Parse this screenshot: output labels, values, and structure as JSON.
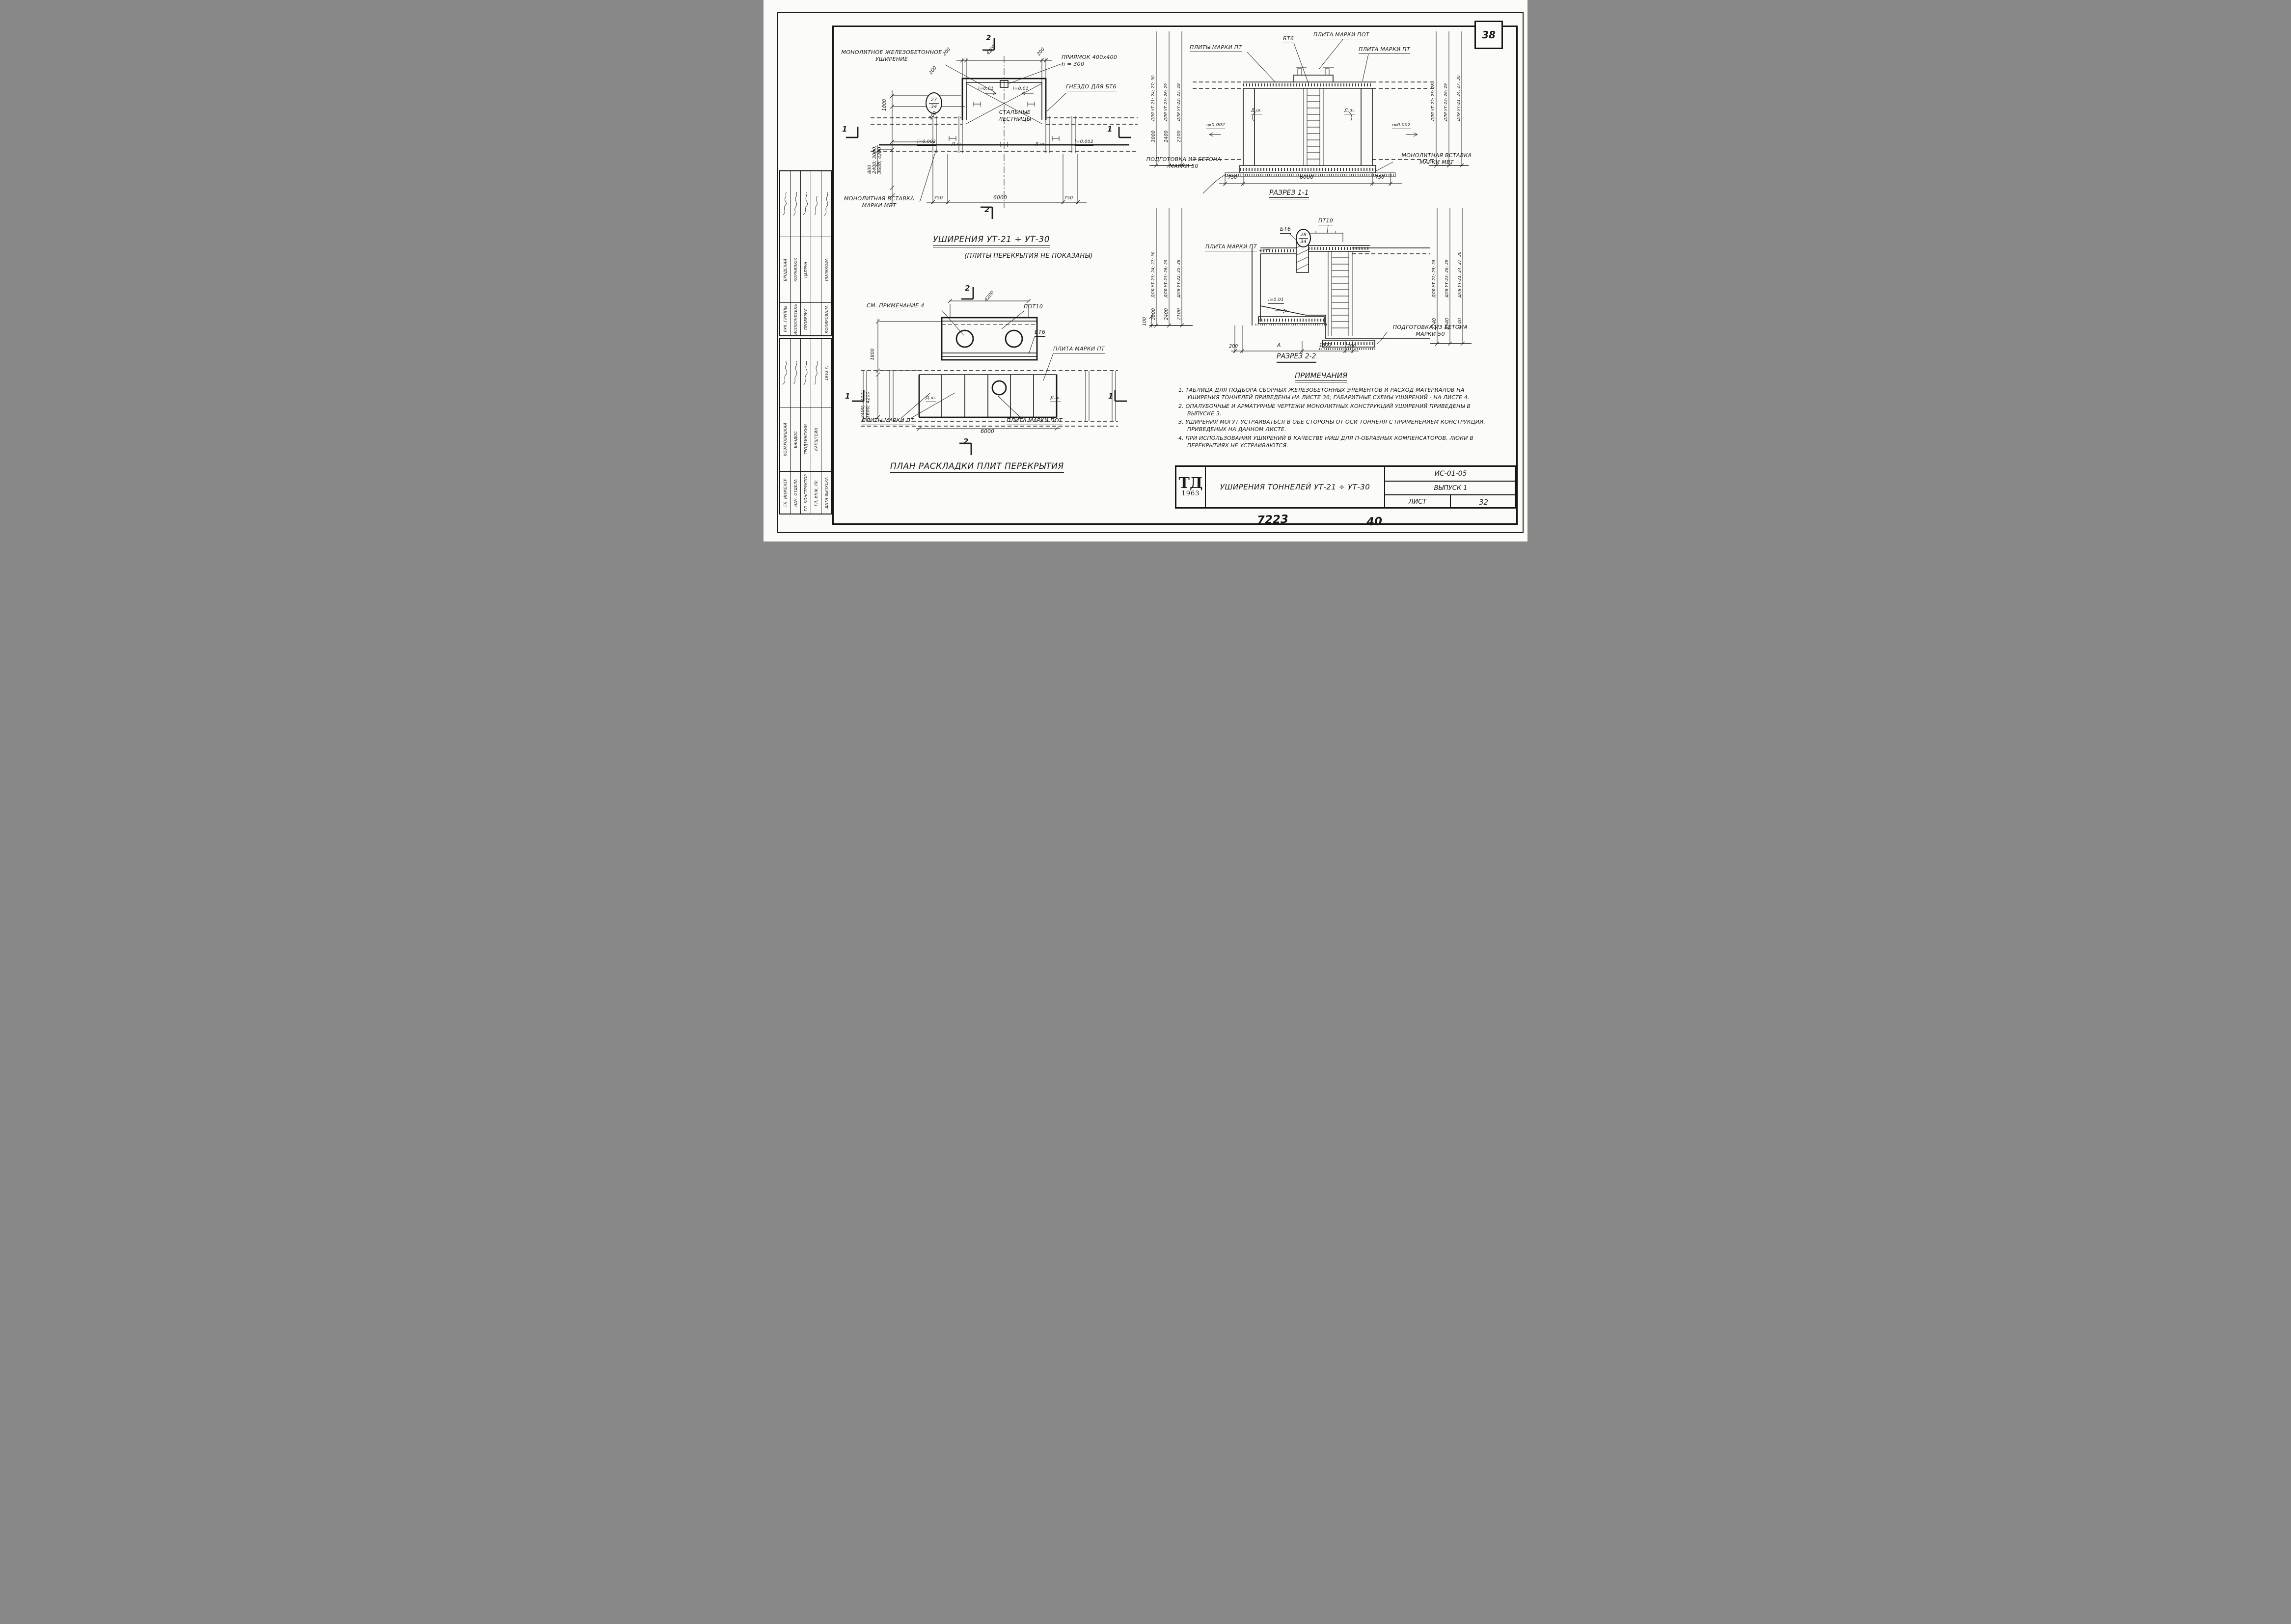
{
  "colors": {
    "ink": "#1a1a1a",
    "paper": "#fbfbf8"
  },
  "page": {
    "corner_number": "38",
    "footer_left": "7223",
    "footer_right": "40"
  },
  "sidebar": {
    "upper": [
      {
        "title": "РУК. ГРУППЫ",
        "name": "БРОДСКИЙ"
      },
      {
        "title": "ИСПОЛНИТЕЛЬ",
        "name": "КОРНИЛЮК"
      },
      {
        "title": "ПРОВЕРИЛ",
        "name": "ЦАПРУН"
      },
      {
        "title": "",
        "name": ""
      },
      {
        "title": "КОПИРОВАЛА",
        "name": "ПОЛЯКОВА"
      }
    ],
    "lower": [
      {
        "title": "ГЛ. ИНЖЕНЕР",
        "name": "КОЗАРОВИЦКИЙ"
      },
      {
        "title": "НАЧ. ОТДЕЛА",
        "name": "БАНДОС"
      },
      {
        "title": "ГЛ. КОНСТРУКТОР",
        "name": "ГРОДЗИНСКИЙ"
      },
      {
        "title": "ГЛ. ИНЖ. ПР.",
        "name": "КАПШТЕЙН"
      },
      {
        "title": "ДАТА ВЫПУСКА",
        "name": "1963 г."
      }
    ]
  },
  "plan_top": {
    "title": "УШИРЕНИЯ  УТ-21 ÷ УТ-30",
    "subtitle": "(ПЛИТЫ  ПЕРЕКРЫТИЯ  НЕ  ПОКАЗАНЫ)",
    "labels": {
      "widening": "МОНОЛИТНОЕ  ЖЕЛЕЗОБЕТОННОЕ\nУШИРЕНИЕ",
      "pit": "ПРИЯМОК  400х400\nh = 300",
      "socket": "ГНЕЗДО  ДЛЯ  БТ6",
      "stairs": "СТАЛЬНЫЕ\nЛЕСТНИЦЫ",
      "insert": "МОНОЛИТНАЯ  ВСТАВКА\nМАРКИ  МВТ",
      "slope_pit_left": "i=0.01",
      "slope_pit_right": "i=0.01",
      "slope_left": "i=0.002",
      "slope_right": "i=0.002",
      "joint_left": "Д.ш.",
      "joint_right": "Д.ш."
    },
    "detail_mark": {
      "top": "27",
      "bottom": "34"
    },
    "dims": {
      "top": [
        "200",
        "4200",
        "200"
      ],
      "left": [
        "200",
        "1800",
        "200"
      ],
      "left_range": "2400; 3000;\n3600; 4200",
      "left_lower": "800",
      "bottom": [
        "750",
        "6000",
        "750"
      ]
    },
    "marks": {
      "top": "2",
      "bottom": "2",
      "left": "1",
      "right": "1"
    }
  },
  "plan_bottom": {
    "title": "ПЛАН  РАСКЛАДКИ  ПЛИТ  ПЕРЕКРЫТИЯ",
    "labels": {
      "see_note": "СМ. ПРИМЕЧАНИЕ  4",
      "pot10": "ПОТ10",
      "bt6": "БТ6",
      "plate_pt": "ПЛИТА  МАРКИ  ПТ",
      "plates_pt": "ПЛИТЫ  МАРКИ  ПТ",
      "plate_pot": "ПЛИТА  МАРКИ  ПОТ",
      "joint_left": "Д.ш.",
      "joint_right": "Д.ш."
    },
    "dims": {
      "top": "4200",
      "left": "1800",
      "left_range": "2400; 3000;\n3600; 4200",
      "bottom": "6000"
    },
    "marks": {
      "top": "2",
      "bottom": "2",
      "left": "1",
      "right": "1"
    }
  },
  "section1": {
    "title": "РАЗРЕЗ  1-1",
    "labels": {
      "plates_pt": "ПЛИТЫ  МАРКИ  ПТ",
      "bt6": "БТ6",
      "plate_pot": "ПЛИТА  МАРКИ  ПОТ",
      "plate_pt": "ПЛИТА  МАРКИ  ПТ",
      "joint_left": "Д.ш.",
      "joint_right": "Д.ш.",
      "slope_left": "i=0.002",
      "slope_right": "i=0.002",
      "prep": "ПОДГОТОВКА  ИЗ  БЕТОНА\nМАРКИ  50",
      "insert": "МОНОЛИТНАЯ  ВСТАВКА\nМАРКИ  МВТ"
    },
    "cols_left": [
      "ДЛЯ УТ-21; 24; 27; 30",
      "ДЛЯ УТ-23; 26; 29",
      "ДЛЯ УТ-22; 25; 28"
    ],
    "cols_right": [
      "ДЛЯ УТ-22; 25; 28",
      "ДЛЯ УТ-23; 26; 29",
      "ДЛЯ УТ-21; 24; 27; 30"
    ],
    "dims_left": [
      "3000",
      "2400",
      "2100"
    ],
    "dims_bottom": [
      "750",
      "6000",
      "750"
    ]
  },
  "section2": {
    "title": "РАЗРЕЗ  2-2",
    "labels": {
      "plate_pt": "ПЛИТА  МАРКИ  ПТ",
      "bt6": "БТ6",
      "pt10": "ПТ10",
      "slope": "i=0.01",
      "prep": "ПОДГОТОВКА  ИЗ  БЕТОНА\nМАРКИ  50"
    },
    "detail_mark": {
      "top": "28",
      "bottom": "34"
    },
    "cols_left": [
      "ДЛЯ УТ-21; 24; 27; 30",
      "ДЛЯ УТ-23; 26; 29",
      "ДЛЯ УТ-22; 25; 28"
    ],
    "cols_right": [
      "ДЛЯ УТ-22; 25; 28",
      "ДЛЯ УТ-23; 26; 29",
      "ДЛЯ УТ-21; 24; 27; 30"
    ],
    "dims_left": [
      "3000",
      "2400",
      "2100"
    ],
    "dims_right": [
      "2240",
      "2540",
      "3140"
    ],
    "dims_bottom": [
      "200",
      "А",
      "1800",
      "200"
    ],
    "dim_step": "100"
  },
  "notes": {
    "heading": "ПРИМЕЧАНИЯ",
    "items": [
      "1. ТАБЛИЦА  ДЛЯ  ПОДБОРА  СБОРНЫХ  ЖЕЛЕЗОБЕТОННЫХ  ЭЛЕМЕНТОВ  И РАСХОД  МАТЕРИАЛОВ  НА  УШИРЕНИЯ  ТОННЕЛЕЙ  ПРИВЕДЕНЫ  НА ЛИСТЕ  36;  ГАБАРИТНЫЕ  СХЕМЫ  УШИРЕНИЙ  -  НА  ЛИСТЕ  4.",
      "2. ОПАЛУБОЧНЫЕ  И  АРМАТУРНЫЕ  ЧЕРТЕЖИ  МОНОЛИТНЫХ  КОНСТРУКЦИЙ УШИРЕНИЙ  ПРИВЕДЕНЫ  В  ВЫПУСКЕ  3.",
      "3. УШИРЕНИЯ  МОГУТ  УСТРАИВАТЬСЯ  В  ОБЕ  СТОРОНЫ  ОТ  ОСИ  ТОННЕЛЯ  С ПРИМЕНЕНИЕМ  КОНСТРУКЦИЙ,  ПРИВЕДЕНЫХ  НА  ДАННОМ  ЛИСТЕ.",
      "4. ПРИ  ИСПОЛЬЗОВАНИИ  УШИРЕНИЙ  В  КАЧЕСТВЕ  НИШ  ДЛЯ  П-ОБРАЗНЫХ КОМПЕНСАТОРОВ,  ЛЮКИ  В  ПЕРЕКРЫТИЯХ  НЕ  УСТРАИВАЮТСЯ."
    ]
  },
  "titleblock": {
    "org": "ТД",
    "year": "1963",
    "title": "УШИРЕНИЯ  ТОННЕЛЕЙ  УТ-21 ÷ УТ-30",
    "code": "ИС-01-05",
    "issue": "ВЫПУСК 1",
    "sheet_label": "ЛИСТ",
    "sheet_number": "32"
  }
}
